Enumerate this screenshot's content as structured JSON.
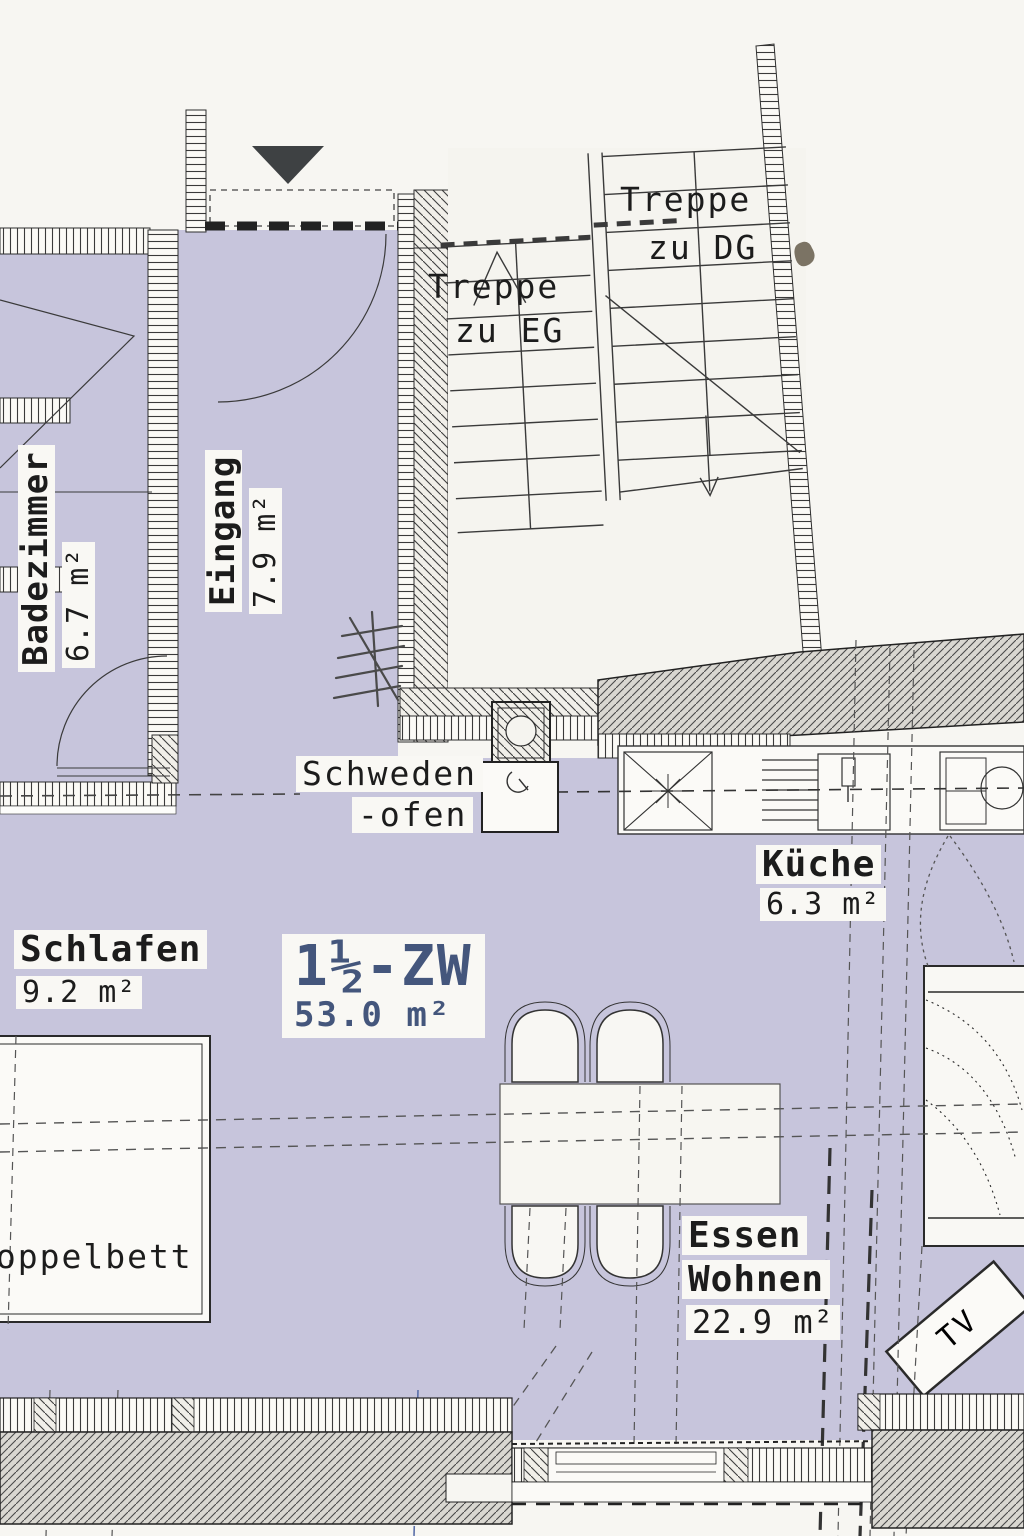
{
  "document": {
    "type": "apartment floor plan scan"
  },
  "unit": {
    "label": "1½-ZW",
    "area": "53.0 m²"
  },
  "rooms": {
    "badezimmer": {
      "name": "Badezimmer",
      "area": "6.7 m²"
    },
    "eingang": {
      "name": "Eingang",
      "area": "7.9 m²"
    },
    "kueche": {
      "name": "Küche",
      "area": "6.3 m²"
    },
    "schlafen": {
      "name": "Schlafen",
      "area": "9.2 m²"
    },
    "essen_wohnen": {
      "line1": "Essen",
      "line2": "Wohnen",
      "area": "22.9 m²"
    }
  },
  "stairs": {
    "eg": {
      "line1": "Treppe",
      "line2": "zu EG"
    },
    "dg": {
      "line1": "Treppe",
      "line2": "zu DG"
    }
  },
  "features": {
    "stove_line1": "Schweden",
    "stove_line2": "-ofen",
    "bed": "Doppelbett",
    "tv": "TV"
  },
  "colors": {
    "floor_fill": "#c7c5dc",
    "unit_label_blue": "#44567c",
    "paper": "#f7f6f2",
    "ink": "#1c1c1c"
  }
}
